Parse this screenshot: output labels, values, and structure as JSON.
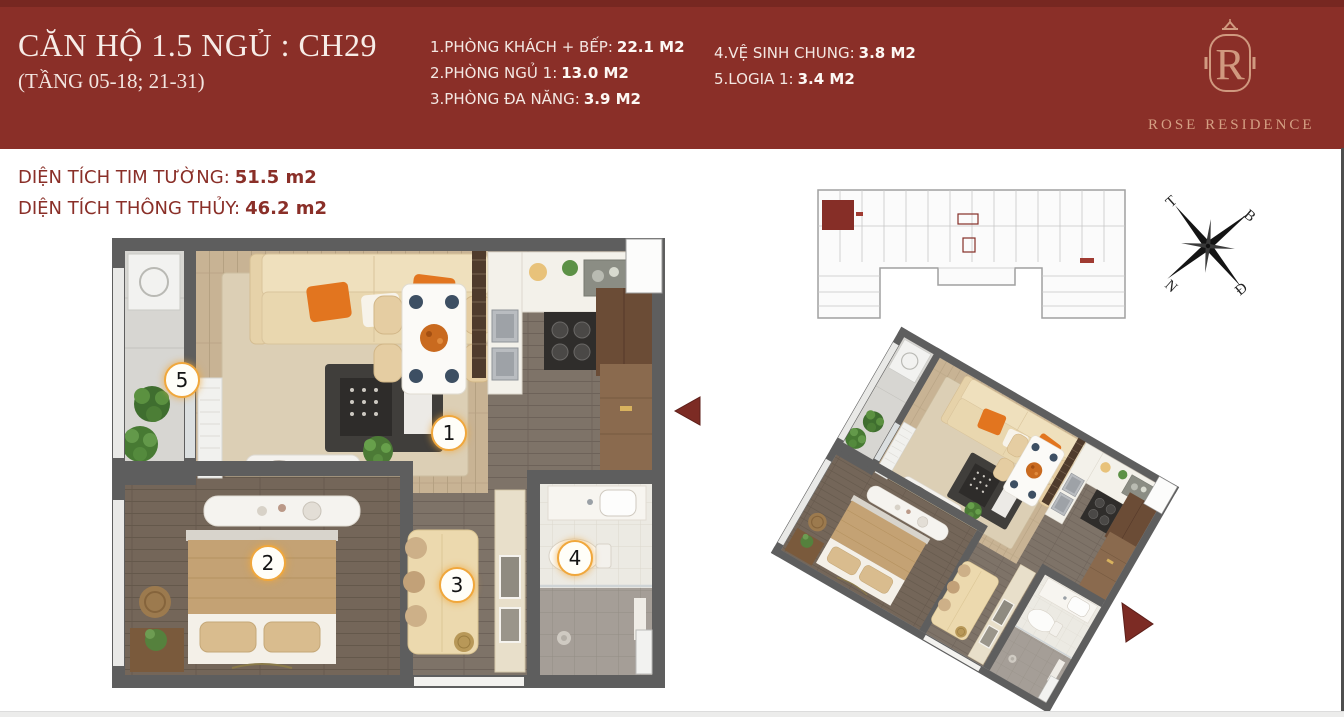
{
  "header": {
    "title": "CĂN HỘ 1.5 NGỦ : CH29",
    "floors": "(TẦNG 05-18; 21-31)",
    "brand": "ROSE RESIDENCE",
    "monogram": "R"
  },
  "legend": {
    "col1": [
      {
        "label": "1.PHÒNG KHÁCH + BẾP:",
        "value": "22.1 M2"
      },
      {
        "label": "2.PHÒNG NGỦ 1:",
        "value": "13.0 M2"
      },
      {
        "label": "3.PHÒNG ĐA NĂNG:",
        "value": "3.9 M2"
      }
    ],
    "col2": [
      {
        "label": "4.VỆ SINH CHUNG:",
        "value": "3.8 M2"
      },
      {
        "label": "5.LOGIA 1:",
        "value": "3.4 M2"
      }
    ]
  },
  "areas": [
    {
      "label": "DIỆN TÍCH TIM TƯỜNG:",
      "value": "51.5 m2"
    },
    {
      "label": "DIỆN TÍCH THÔNG THỦY:",
      "value": "46.2 m2"
    }
  ],
  "markers": [
    "1",
    "2",
    "3",
    "4",
    "5"
  ],
  "compass": {
    "west": "T",
    "north": "B",
    "south": "N",
    "east": "Đ"
  },
  "colors": {
    "accent_red": "#8a2f28",
    "rose_gold": "#d5a084",
    "marker_ring": "#f0a73c",
    "wall_gray": "#5e5e5e"
  }
}
